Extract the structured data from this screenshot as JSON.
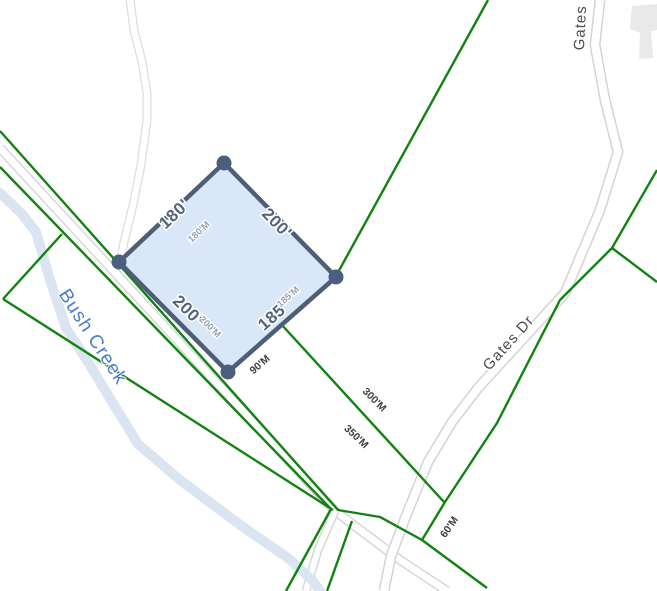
{
  "map": {
    "type": "parcel-boundary-map",
    "labels": {
      "road_gates_dr": "Gates Dr",
      "road_gates": "Gates",
      "creek": "Bush Creek"
    },
    "parcel": {
      "fill_color": "#d4e4f7",
      "outline_color": "#4e5e75",
      "vertex_color": "#4a5e80",
      "edges": [
        {
          "side": "northwest",
          "length": "180'",
          "measured": "180'M"
        },
        {
          "side": "northeast",
          "length": "200'"
        },
        {
          "side": "southwest",
          "length": "200'",
          "measured": "200'M"
        },
        {
          "side": "southeast",
          "length": "185'",
          "measured": "185'M"
        }
      ]
    },
    "measurements": {
      "m90": "90'M",
      "m300": "300'M",
      "m350": "350'M",
      "m60": "60'M"
    },
    "colors": {
      "boundary_green": "#128312",
      "creek_blue": "#dbe5f2",
      "creek_label_blue": "#4a7cc7",
      "road_casing_gray": "#d7d7d7",
      "road_fill": "#ffffff",
      "dimension_text": "#57637a",
      "measured_text_light": "#99a2b2",
      "measured_text_dark": "#3e3e3e",
      "road_label_text": "#4c4c4c",
      "building_gray": "#e9e9e9"
    }
  }
}
